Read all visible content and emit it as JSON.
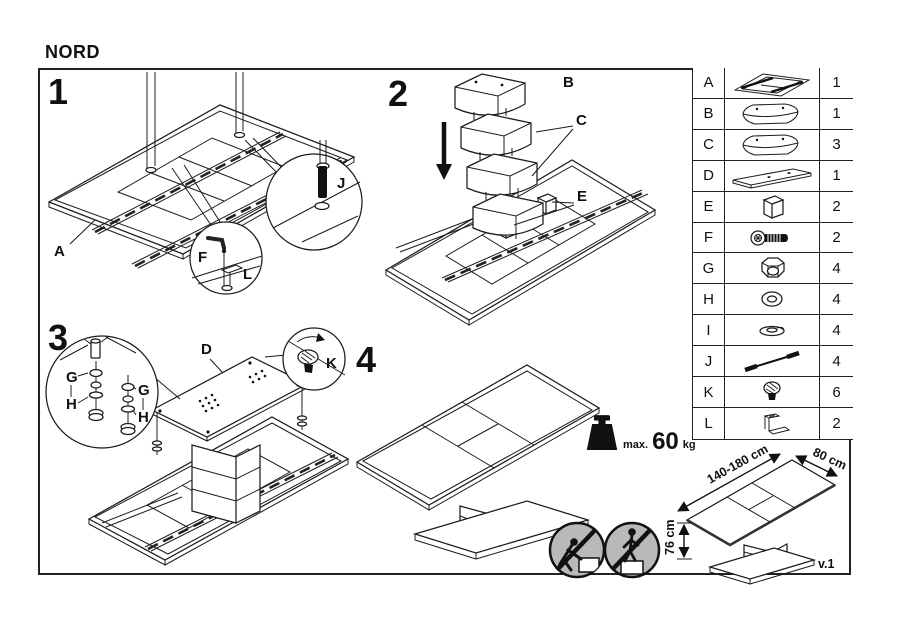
{
  "title": "NORD",
  "version": "v.1",
  "steps": {
    "s1": {
      "number": "1",
      "part_a": "A",
      "part_f": "F",
      "part_l": "L",
      "part_j": "J"
    },
    "s2": {
      "number": "2",
      "part_b": "B",
      "part_c": "C",
      "part_e": "E"
    },
    "s3": {
      "number": "3",
      "part_d": "D",
      "part_g": "G",
      "part_h": "H",
      "part_k": "K"
    },
    "s4": {
      "number": "4"
    }
  },
  "weight_limit": {
    "prefix": "max.",
    "value": "60",
    "unit": "kg"
  },
  "dimensions": {
    "length": "140-180 cm",
    "width": "80 cm",
    "height": "76 cm"
  },
  "parts_table": {
    "rows": [
      {
        "id": "A",
        "qty": "1",
        "icon": "tabletop-frame-icon"
      },
      {
        "id": "B",
        "qty": "1",
        "icon": "column-top-segment-icon"
      },
      {
        "id": "C",
        "qty": "3",
        "icon": "column-segment-icon"
      },
      {
        "id": "D",
        "qty": "1",
        "icon": "base-plate-icon"
      },
      {
        "id": "E",
        "qty": "2",
        "icon": "spacer-block-icon"
      },
      {
        "id": "F",
        "qty": "2",
        "icon": "bolt-icon"
      },
      {
        "id": "G",
        "qty": "4",
        "icon": "lock-nut-icon"
      },
      {
        "id": "H",
        "qty": "4",
        "icon": "washer-icon"
      },
      {
        "id": "I",
        "qty": "4",
        "icon": "flat-washer-icon"
      },
      {
        "id": "J",
        "qty": "4",
        "icon": "threaded-pin-icon"
      },
      {
        "id": "K",
        "qty": "6",
        "icon": "knurled-screw-icon"
      },
      {
        "id": "L",
        "qty": "2",
        "icon": "l-bracket-icon"
      }
    ]
  }
}
